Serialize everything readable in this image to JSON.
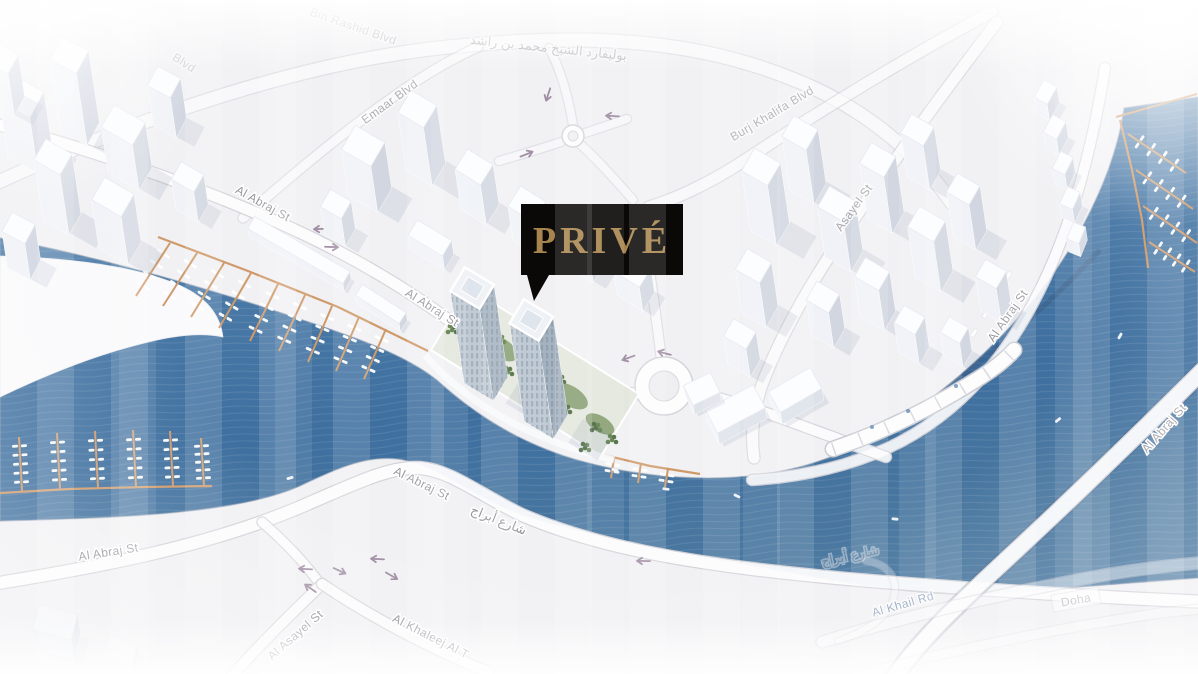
{
  "callout": {
    "label": "PRIVÉ",
    "bg": "#0b0907",
    "text_color": "#a8854e"
  },
  "streets": {
    "rashid_blvd": "Bin Rashid Blvd",
    "rashid_blvd_arabic": "بوليفارد الشيخ محمد بن راشد",
    "emaar_blvd": "Emaar Blvd",
    "burj_khalifa_blvd": "Burj Khalifa Blvd",
    "asayel_st": "Asayel St",
    "al_asayel_st": "Al Asayel St",
    "al_abraj_st": "Al Abraj St",
    "al_abraj_st_arabic": "شارع أبراج",
    "al_khaleej_al_t": "Al Khaleej Al T",
    "al_khail_rd": "Al Khail Rd",
    "doha_st": "Doha",
    "blvd_fragment": "Blvd"
  },
  "colors": {
    "water": "#4c7ba8",
    "water_deep": "#3e6f9f",
    "land": "#f1f1f4",
    "road_fill": "#fdfdfe",
    "road_casing": "#d5d3d9",
    "street_label": "#96959c",
    "street_label_blue": "#7d94b6",
    "dock": "#cf9a6a",
    "boat": "#ffffff",
    "arrow": "#8c7590",
    "building_top": "#fcfdff",
    "building_face_light": "#f2f4f8",
    "building_face_dark": "#c2c9d6",
    "tower_facade": "#a9b8c8",
    "greenery": "#5d7f49"
  }
}
